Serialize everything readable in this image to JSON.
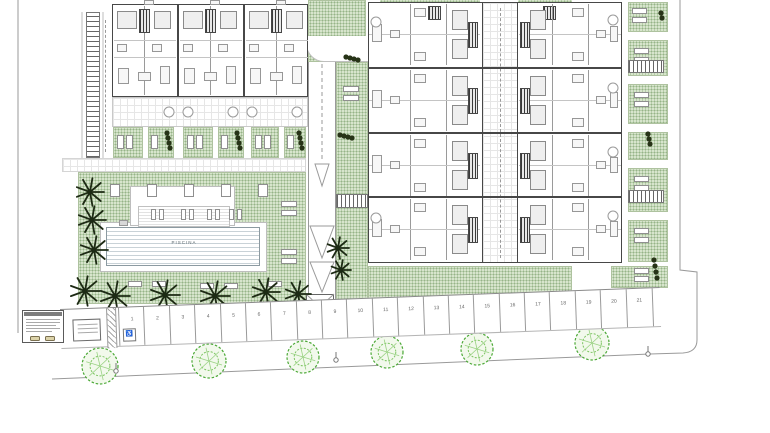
{
  "drawing": {
    "pool_label": "PISCINA",
    "parking": {
      "numbers": [
        "1",
        "2",
        "3",
        "4",
        "5",
        "6",
        "7",
        "8",
        "9",
        "10",
        "11",
        "12",
        "13",
        "14",
        "15",
        "16",
        "17",
        "18",
        "19",
        "20",
        "21"
      ],
      "accessible_icon": "♿"
    },
    "icons": {
      "palm_tree": "palm-tree-icon",
      "street_tree": "street-tree-icon",
      "accessible_parking": "wheelchair-icon"
    },
    "colors": {
      "garden_green": "#d7e5cc",
      "garden_dot": "#96b487",
      "palm_dark": "#1d2a14",
      "street_tree_green": "#4aa835",
      "wall_dark": "#474747",
      "line_gray": "#9a9a9a",
      "pool_line": "#c9d2d7",
      "car_tan": "#dcd3a9"
    }
  }
}
